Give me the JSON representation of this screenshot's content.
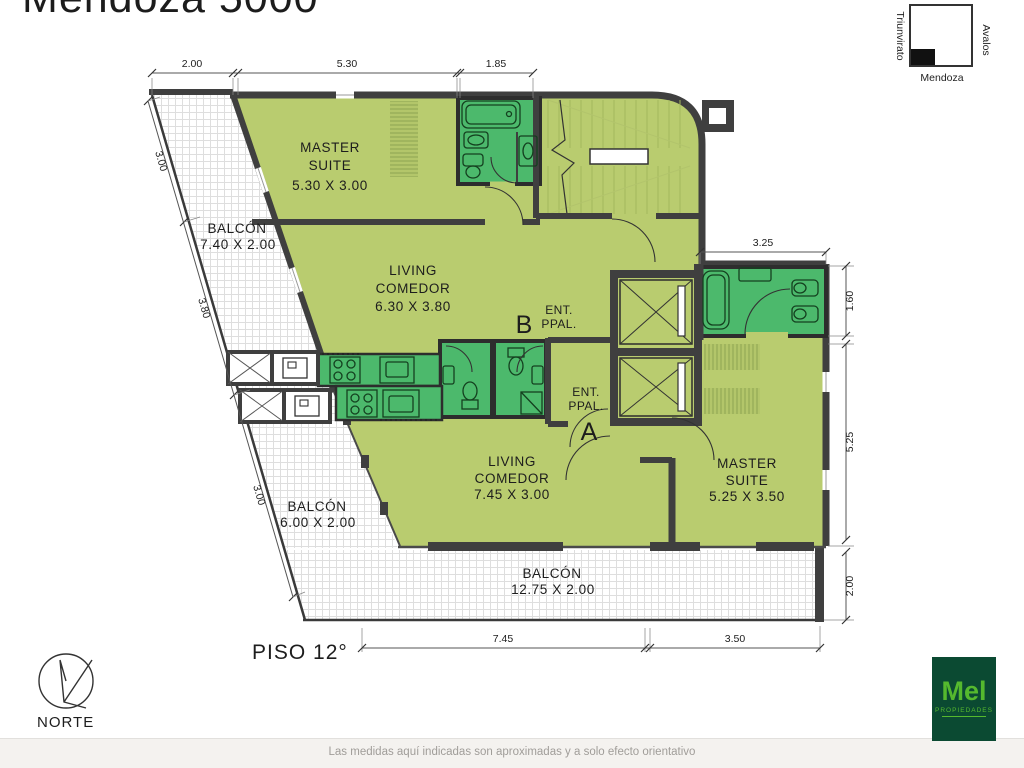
{
  "title": "Mendoza 5000",
  "locator": {
    "left": "Triunvirato",
    "right": "Avalos",
    "bottom": "Mendoza"
  },
  "floor": {
    "label": "PISO 12°"
  },
  "compass": {
    "label": "NORTE"
  },
  "units": {
    "b": {
      "master": {
        "l1": "MASTER",
        "l2": "SUITE",
        "size": "5.30 X 3.00"
      },
      "living": {
        "l1": "LIVING",
        "l2": "COMEDOR",
        "size": "6.30 X 3.80"
      },
      "balcony": {
        "name": "BALCÓN",
        "size": "7.40 X 2.00"
      },
      "entry": {
        "l1": "ENT.",
        "l2": "PPAL.",
        "unit": "B"
      }
    },
    "a": {
      "master": {
        "l1": "MASTER",
        "l2": "SUITE",
        "size": "5.25 X 3.50"
      },
      "living": {
        "l1": "LIVING",
        "l2": "COMEDOR",
        "size": "7.45 X 3.00"
      },
      "balcony": {
        "name": "BALCÓN",
        "size": "6.00 X 2.00"
      },
      "entry": {
        "l1": "ENT.",
        "l2": "PPAL.",
        "unit": "A"
      }
    }
  },
  "shared_balcony": {
    "name": "BALCÓN",
    "size": "12.75 X 2.00"
  },
  "dims": {
    "top": [
      "2.00",
      "5.30",
      "1.85"
    ],
    "left": [
      "3.00",
      "3.80",
      "3.00"
    ],
    "right": [
      "3.25",
      "1.60",
      "5.25",
      "2.00"
    ],
    "bottom": [
      "7.45",
      "3.50"
    ]
  },
  "footer": {
    "disclaimer": "Las medidas aquí indicadas son aproximadas y a solo efecto orientativo"
  },
  "logo": {
    "name": "Mel",
    "sub": "PROPIEDADES"
  },
  "colors": {
    "room": "#b9cc6f",
    "wet": "#4cb96c",
    "wall": "#3f3f3f",
    "logo_bg": "#0b4a32",
    "logo_text": "#55b92e"
  }
}
